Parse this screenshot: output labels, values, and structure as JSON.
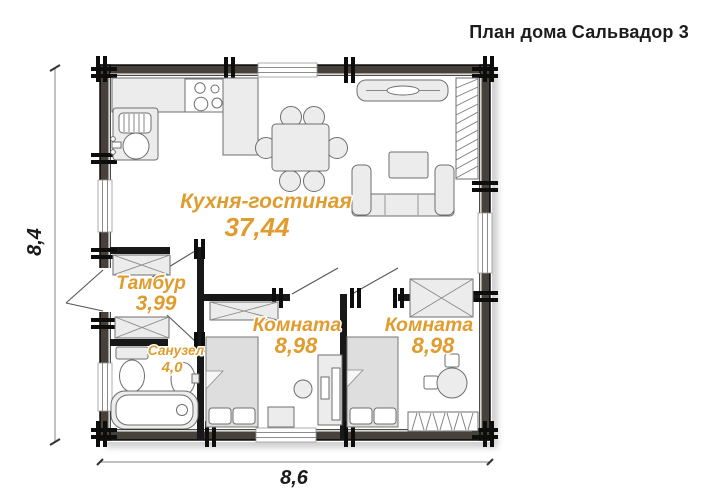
{
  "title": "План дома Сальвадор 3",
  "dimensions": {
    "height": "8,4",
    "width": "8,6"
  },
  "rooms": {
    "living": {
      "name": "Кухня-гостиная",
      "area": "37,44"
    },
    "tambour": {
      "name": "Тамбур",
      "area": "3,99"
    },
    "bathroom": {
      "name": "Санузел",
      "area": "4,0"
    },
    "bedroom_left": {
      "name": "Комната",
      "area": "8,98"
    },
    "bedroom_right": {
      "name": "Комната",
      "area": "8,98"
    }
  },
  "colors": {
    "room_label": "#e09c2e",
    "dim_text": "#1a1a1a",
    "wall_dark": "#46423b",
    "furniture_fill": "#ececec"
  },
  "furniture_items": [
    "kitchen-counter",
    "stove",
    "kitchen-sink-unit",
    "dining-table",
    "dining-chair",
    "tv-console",
    "corner-sofa",
    "coffee-table",
    "hatched-storage",
    "x-wardrobe",
    "bed",
    "desk",
    "desk-chair",
    "round-table",
    "stool",
    "toilet",
    "washbasin",
    "bathtub",
    "entrance-door",
    "interior-door",
    "window",
    "log-crown"
  ]
}
